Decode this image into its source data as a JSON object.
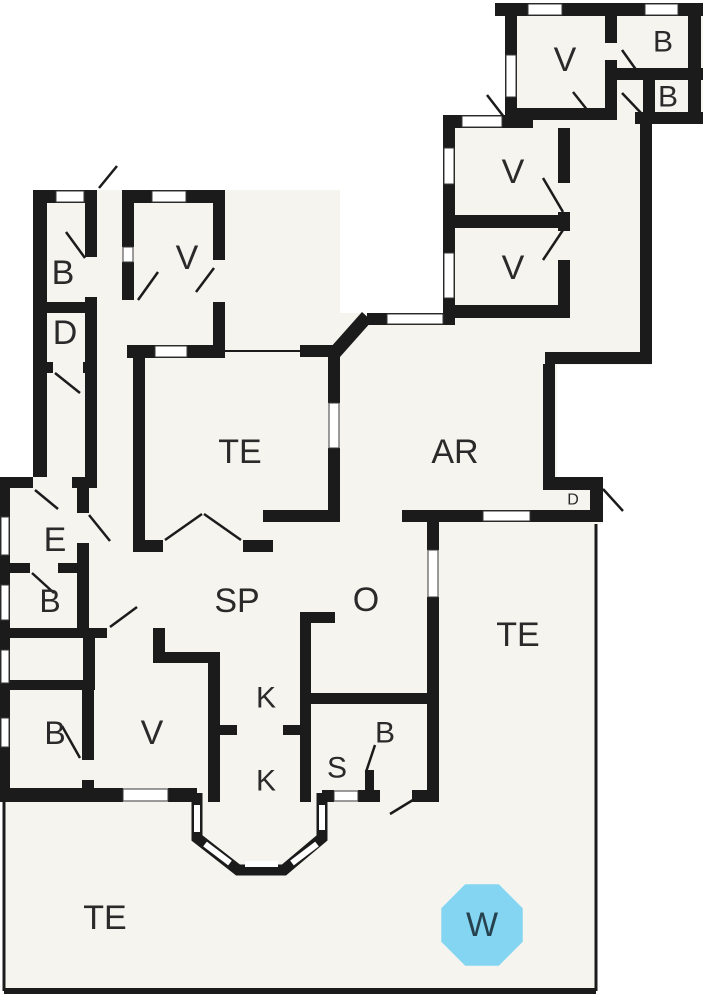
{
  "canvas": {
    "width": 703,
    "height": 1000,
    "background": "#ffffff"
  },
  "colors": {
    "wall": "#1b1b1b",
    "floor": "#f5f4ef",
    "window_fill": "#ffffff",
    "window_stroke": "#3a3a3a",
    "door_line": "#1b1b1b",
    "thin_edge": "#1b1b1b",
    "label_text": "#2a2a2a",
    "marker_fill": "#84d5f2",
    "marker_text": "#27424f"
  },
  "floors": [
    [
      33,
      197,
      64,
      280
    ],
    [
      97,
      190,
      243,
      362
    ],
    [
      0,
      477,
      440,
      325
    ],
    [
      330,
      313,
      227,
      209
    ],
    [
      443,
      115,
      209,
      250
    ],
    [
      505,
      3,
      198,
      121
    ],
    [
      545,
      477,
      58,
      47
    ],
    [
      427,
      512,
      169,
      479
    ],
    [
      4,
      802,
      592,
      189
    ],
    [
      197,
      793,
      125,
      77
    ]
  ],
  "walls": [
    [
      495,
      3,
      208,
      13
    ],
    [
      688,
      3,
      13,
      121
    ],
    [
      505,
      3,
      12,
      110
    ],
    [
      505,
      108,
      112,
      12
    ],
    [
      605,
      3,
      12,
      40
    ],
    [
      605,
      60,
      12,
      60
    ],
    [
      617,
      68,
      86,
      12
    ],
    [
      643,
      80,
      12,
      38
    ],
    [
      635,
      112,
      68,
      12
    ],
    [
      640,
      124,
      12,
      240
    ],
    [
      545,
      352,
      107,
      12
    ],
    [
      543,
      364,
      12,
      126
    ],
    [
      543,
      477,
      60,
      13
    ],
    [
      590,
      490,
      13,
      24
    ],
    [
      443,
      115,
      90,
      13
    ],
    [
      443,
      115,
      12,
      113
    ],
    [
      443,
      228,
      12,
      97
    ],
    [
      443,
      215,
      127,
      13
    ],
    [
      558,
      128,
      12,
      55
    ],
    [
      558,
      212,
      12,
      19
    ],
    [
      558,
      260,
      12,
      46
    ],
    [
      455,
      305,
      115,
      13
    ],
    [
      367,
      313,
      88,
      12
    ],
    [
      33,
      190,
      64,
      13
    ],
    [
      122,
      190,
      103,
      13
    ],
    [
      33,
      190,
      14,
      287
    ],
    [
      85,
      190,
      12,
      67
    ],
    [
      85,
      297,
      12,
      65
    ],
    [
      85,
      362,
      12,
      115
    ],
    [
      33,
      302,
      64,
      11
    ],
    [
      33,
      362,
      20,
      11
    ],
    [
      83,
      362,
      14,
      11
    ],
    [
      122,
      203,
      12,
      44
    ],
    [
      122,
      262,
      12,
      38
    ],
    [
      213,
      203,
      12,
      57
    ],
    [
      213,
      302,
      12,
      45
    ],
    [
      127,
      345,
      98,
      13
    ],
    [
      133,
      345,
      12,
      207
    ],
    [
      328,
      352,
      12,
      51
    ],
    [
      328,
      448,
      12,
      69
    ],
    [
      300,
      345,
      40,
      12
    ],
    [
      133,
      540,
      30,
      12
    ],
    [
      243,
      540,
      30,
      12
    ],
    [
      263,
      510,
      77,
      12
    ],
    [
      402,
      510,
      201,
      12
    ],
    [
      300,
      612,
      11,
      190
    ],
    [
      300,
      612,
      35,
      11
    ],
    [
      305,
      693,
      123,
      11
    ],
    [
      208,
      725,
      29,
      10
    ],
    [
      283,
      725,
      28,
      10
    ],
    [
      365,
      770,
      9,
      22
    ],
    [
      322,
      790,
      12,
      12
    ],
    [
      358,
      790,
      22,
      12
    ],
    [
      412,
      790,
      16,
      12
    ],
    [
      427,
      512,
      12,
      38
    ],
    [
      427,
      597,
      12,
      205
    ],
    [
      0,
      477,
      10,
      325
    ],
    [
      0,
      477,
      33,
      11
    ],
    [
      72,
      477,
      25,
      11
    ],
    [
      77,
      477,
      12,
      36
    ],
    [
      77,
      543,
      12,
      20
    ],
    [
      10,
      563,
      20,
      10
    ],
    [
      58,
      563,
      19,
      10
    ],
    [
      77,
      563,
      12,
      65
    ],
    [
      10,
      628,
      97,
      10
    ],
    [
      153,
      628,
      12,
      35
    ],
    [
      153,
      652,
      67,
      11
    ],
    [
      208,
      663,
      12,
      139
    ],
    [
      83,
      628,
      12,
      62
    ],
    [
      10,
      680,
      77,
      10
    ],
    [
      82,
      690,
      12,
      70
    ],
    [
      82,
      780,
      12,
      10
    ],
    [
      10,
      788,
      113,
      14
    ],
    [
      168,
      788,
      29,
      14
    ]
  ],
  "diagonal_walls": [
    {
      "points": "330,348 362,312 372,321 340,357"
    }
  ],
  "windows": [
    [
      528,
      4,
      34,
      11
    ],
    [
      645,
      4,
      33,
      11
    ],
    [
      506,
      55,
      10,
      42
    ],
    [
      462,
      116,
      40,
      11
    ],
    [
      444,
      148,
      10,
      36
    ],
    [
      444,
      253,
      10,
      45
    ],
    [
      387,
      314,
      56,
      10
    ],
    [
      329,
      403,
      10,
      45
    ],
    [
      56,
      191,
      28,
      11
    ],
    [
      152,
      191,
      34,
      11
    ],
    [
      123,
      247,
      10,
      15
    ],
    [
      155,
      346,
      32,
      11
    ],
    [
      483,
      511,
      47,
      10
    ],
    [
      428,
      550,
      10,
      47
    ],
    [
      334,
      791,
      24,
      10
    ],
    [
      1,
      517,
      8,
      38
    ],
    [
      1,
      585,
      8,
      35
    ],
    [
      1,
      650,
      8,
      33
    ],
    [
      1,
      718,
      8,
      29
    ],
    [
      123,
      789,
      45,
      12
    ]
  ],
  "bay": {
    "path": "M197,793 L197,838 L238,870 L284,870 L322,838 L322,793",
    "wall_width": 11,
    "window_width": 6,
    "windows": [
      [
        197,
        805,
        197,
        832
      ],
      [
        205,
        844,
        230,
        863
      ],
      [
        245,
        864,
        278,
        864
      ],
      [
        292,
        863,
        317,
        844
      ],
      [
        322,
        805,
        322,
        830
      ]
    ]
  },
  "thin_edges": [
    [
      225,
      351,
      300,
      351,
      2
    ],
    [
      596,
      524,
      596,
      991,
      3
    ],
    [
      4,
      802,
      4,
      991,
      3
    ],
    [
      4,
      991,
      596,
      991,
      6
    ]
  ],
  "doors": [
    [
      99,
      188,
      117,
      166
    ],
    [
      66,
      232,
      85,
      258
    ],
    [
      55,
      373,
      80,
      393
    ],
    [
      138,
      300,
      158,
      272
    ],
    [
      196,
      292,
      214,
      268
    ],
    [
      165,
      540,
      202,
      514
    ],
    [
      241,
      540,
      204,
      514
    ],
    [
      35,
      490,
      58,
      509
    ],
    [
      89,
      515,
      110,
      541
    ],
    [
      32,
      573,
      54,
      593
    ],
    [
      110,
      627,
      137,
      607
    ],
    [
      62,
      726,
      80,
      758
    ],
    [
      390,
      814,
      426,
      792
    ],
    [
      375,
      745,
      366,
      772
    ],
    [
      603,
      489,
      623,
      511
    ],
    [
      543,
      178,
      563,
      212
    ],
    [
      563,
      230,
      543,
      260
    ],
    [
      622,
      50,
      637,
      71
    ],
    [
      622,
      93,
      642,
      114
    ],
    [
      487,
      95,
      504,
      117
    ],
    [
      573,
      92,
      592,
      116
    ]
  ],
  "labels": [
    {
      "text": "B",
      "x": 63,
      "y": 273,
      "size": 34
    },
    {
      "text": "D",
      "x": 65,
      "y": 333,
      "size": 34
    },
    {
      "text": "V",
      "x": 187,
      "y": 258,
      "size": 34
    },
    {
      "text": "TE",
      "x": 240,
      "y": 452,
      "size": 34
    },
    {
      "text": "AR",
      "x": 455,
      "y": 452,
      "size": 34
    },
    {
      "text": "V",
      "x": 565,
      "y": 60,
      "size": 34
    },
    {
      "text": "B",
      "x": 663,
      "y": 42,
      "size": 30
    },
    {
      "text": "B",
      "x": 668,
      "y": 97,
      "size": 30
    },
    {
      "text": "V",
      "x": 513,
      "y": 172,
      "size": 34
    },
    {
      "text": "V",
      "x": 513,
      "y": 268,
      "size": 34
    },
    {
      "text": "E",
      "x": 55,
      "y": 540,
      "size": 34
    },
    {
      "text": "B",
      "x": 50,
      "y": 601,
      "size": 32
    },
    {
      "text": "B",
      "x": 55,
      "y": 733,
      "size": 32
    },
    {
      "text": "V",
      "x": 152,
      "y": 733,
      "size": 34
    },
    {
      "text": "SP",
      "x": 237,
      "y": 601,
      "size": 34
    },
    {
      "text": "O",
      "x": 366,
      "y": 600,
      "size": 34
    },
    {
      "text": "K",
      "x": 266,
      "y": 698,
      "size": 30
    },
    {
      "text": "K",
      "x": 266,
      "y": 781,
      "size": 30
    },
    {
      "text": "S",
      "x": 337,
      "y": 768,
      "size": 30
    },
    {
      "text": "B",
      "x": 385,
      "y": 733,
      "size": 30
    },
    {
      "text": "D",
      "x": 573,
      "y": 500,
      "size": 16
    },
    {
      "text": "TE",
      "x": 518,
      "y": 635,
      "size": 34
    },
    {
      "text": "TE",
      "x": 105,
      "y": 918,
      "size": 34
    }
  ],
  "marker": {
    "label": "W",
    "cx": 482,
    "cy": 925,
    "r": 44,
    "size": 34
  }
}
